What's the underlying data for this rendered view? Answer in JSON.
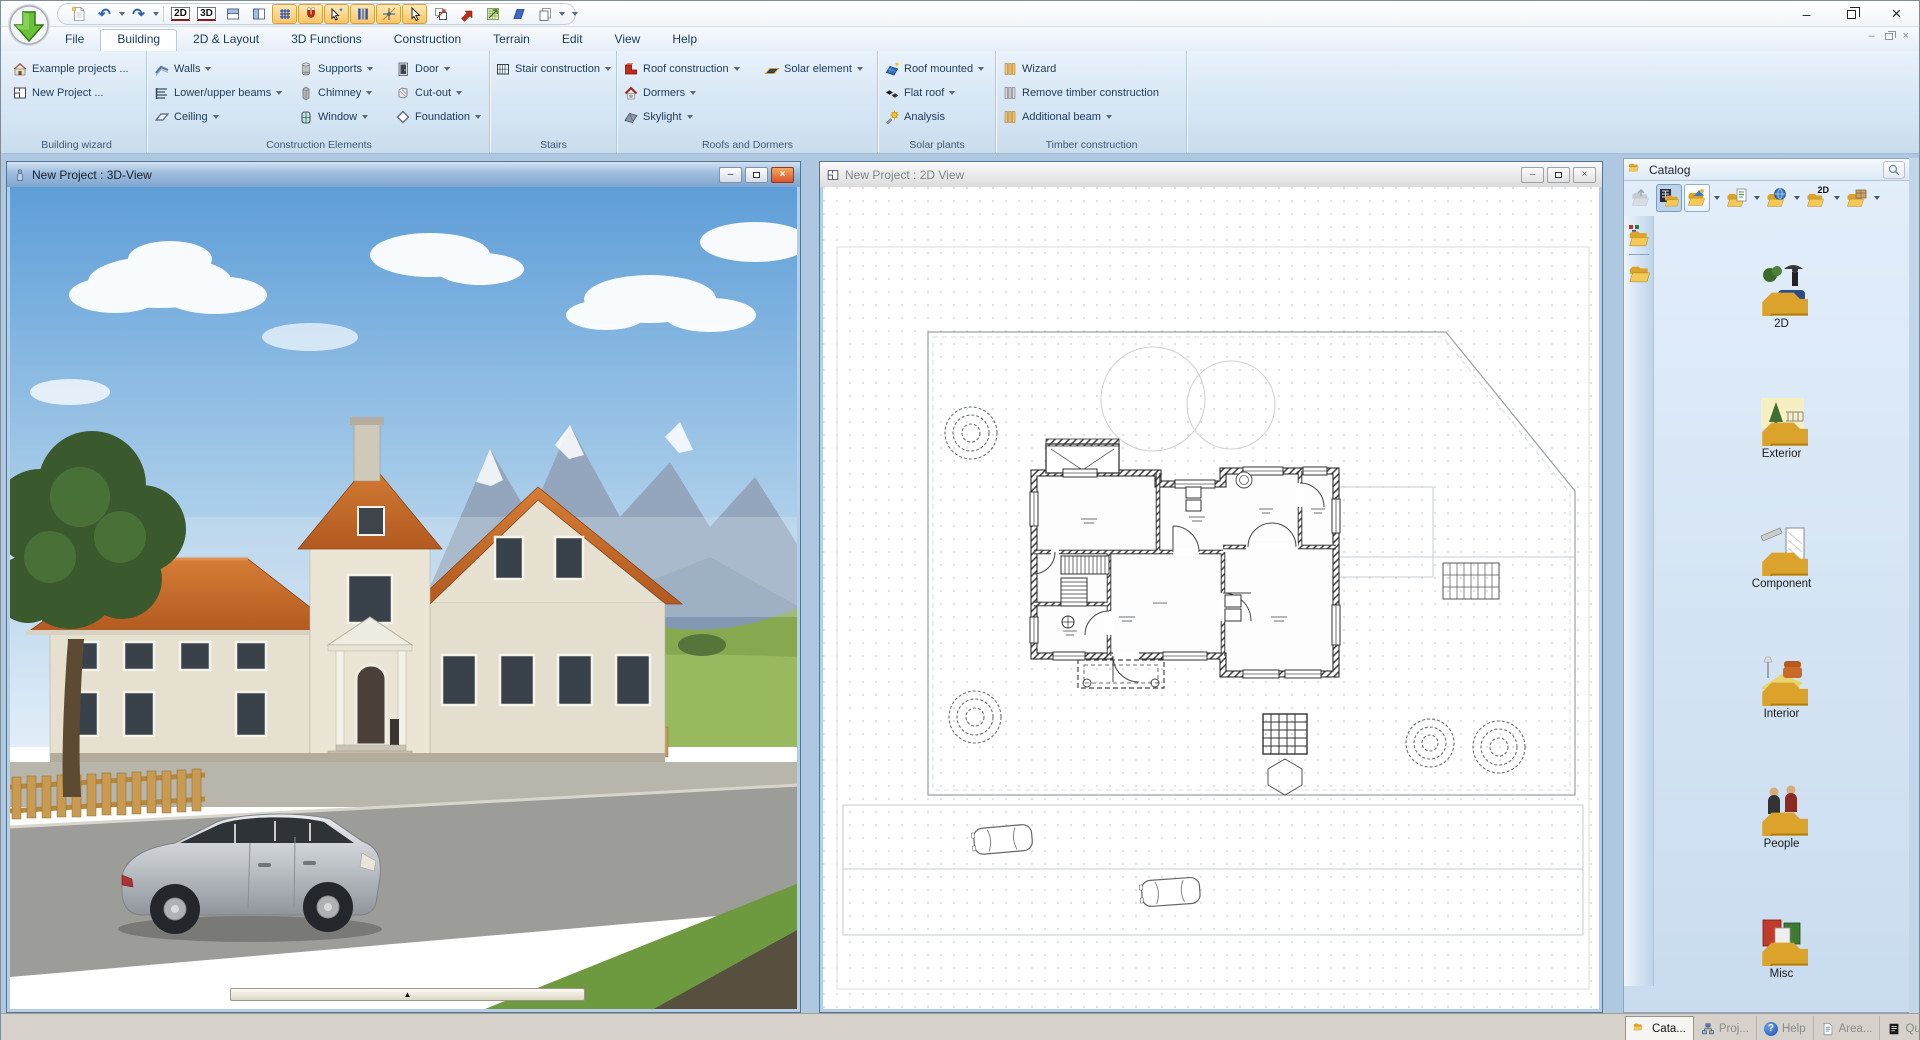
{
  "icons": {
    "undo": "↶",
    "redo": "↷",
    "view2d": "2D",
    "view3d": "3D",
    "slider_marker": "▲",
    "help_glyph": "?",
    "catalog_2d": "2D",
    "min": "–",
    "close": "×"
  },
  "tabs": [
    {
      "label": "File"
    },
    {
      "label": "Building"
    },
    {
      "label": "2D & Layout"
    },
    {
      "label": "3D Functions"
    },
    {
      "label": "Construction"
    },
    {
      "label": "Terrain"
    },
    {
      "label": "Edit"
    },
    {
      "label": "View"
    },
    {
      "label": "Help"
    }
  ],
  "ribbon": {
    "building_wizard": {
      "label": "Building wizard",
      "items": [
        {
          "label": "Example projects ..."
        },
        {
          "label": "New Project ..."
        }
      ]
    },
    "construction_elements": {
      "label": "Construction Elements",
      "items": [
        {
          "label": "Walls"
        },
        {
          "label": "Lower/upper beams"
        },
        {
          "label": "Ceiling"
        },
        {
          "label": "Supports"
        },
        {
          "label": "Chimney"
        },
        {
          "label": "Window"
        },
        {
          "label": "Door"
        },
        {
          "label": "Cut-out"
        },
        {
          "label": "Foundation"
        }
      ]
    },
    "stairs": {
      "label": "Stairs",
      "items": [
        {
          "label": "Stair construction"
        }
      ]
    },
    "roofs": {
      "label": "Roofs and Dormers",
      "items": [
        {
          "label": "Roof construction"
        },
        {
          "label": "Dormers"
        },
        {
          "label": "Skylight"
        },
        {
          "label": "Solar element"
        }
      ]
    },
    "solar": {
      "label": "Solar plants",
      "items": [
        {
          "label": "Roof mounted"
        },
        {
          "label": "Flat roof"
        },
        {
          "label": "Analysis"
        }
      ]
    },
    "timber": {
      "label": "Timber construction",
      "items": [
        {
          "label": "Wizard"
        },
        {
          "label": "Remove timber construction"
        },
        {
          "label": "Additional beam"
        }
      ]
    }
  },
  "windows": {
    "view3d": {
      "title": "New Project : 3D-View"
    },
    "view2d": {
      "title": "New Project : 2D View"
    }
  },
  "catalog": {
    "title": "Catalog",
    "items": [
      {
        "label": "2D"
      },
      {
        "label": "Exterior"
      },
      {
        "label": "Component"
      },
      {
        "label": "Interior"
      },
      {
        "label": "People"
      },
      {
        "label": "Misc"
      }
    ],
    "tabs": [
      {
        "label": "Cata..."
      },
      {
        "label": "Proj..."
      },
      {
        "label": "Help"
      },
      {
        "label": "Area..."
      },
      {
        "label": "Qua..."
      }
    ]
  }
}
